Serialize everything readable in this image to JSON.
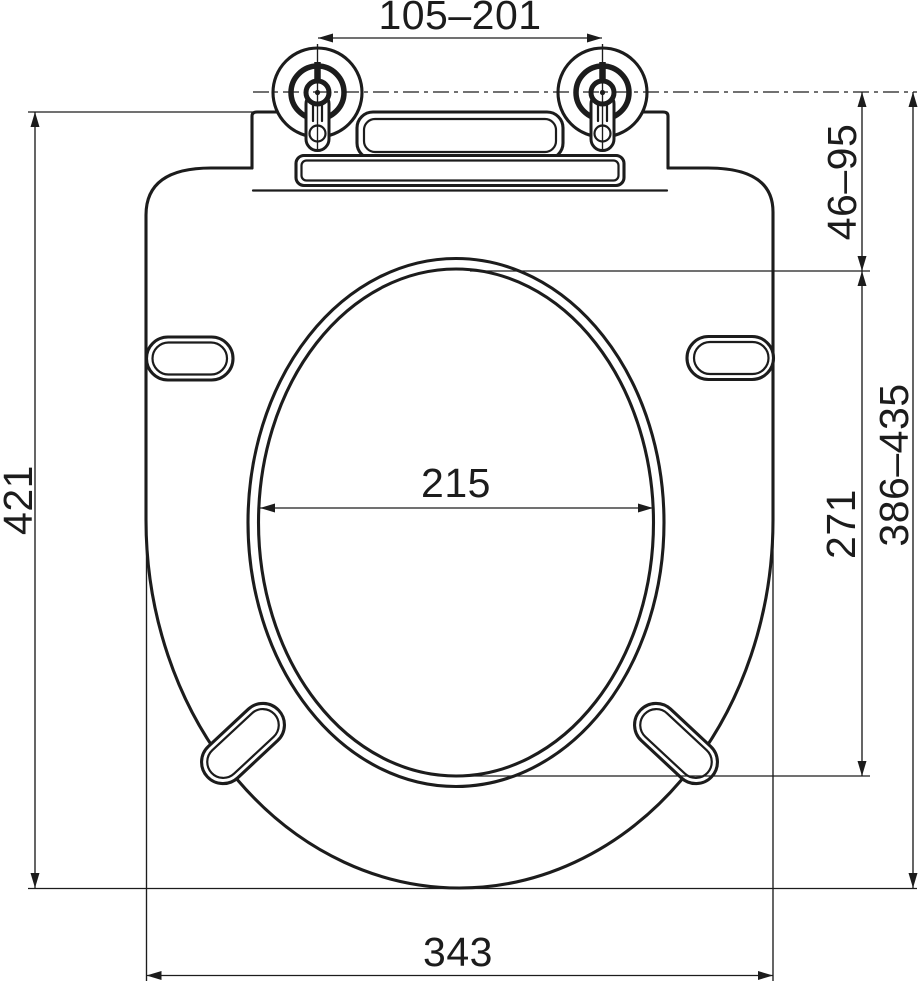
{
  "drawing": {
    "type": "technical-dimension-drawing",
    "subject": "toilet seat with lid, top view, adjustable hinges",
    "line_color": "#1c1c1c",
    "background_color": "#ffffff",
    "units_implied": "mm"
  },
  "dimensions": {
    "hinge_center_spacing": {
      "value": "105–201",
      "orientation": "horizontal",
      "position": "top"
    },
    "overall_length": {
      "value": "421",
      "orientation": "vertical",
      "position": "left"
    },
    "hinge_axis_to_opening": {
      "value": "46–95",
      "orientation": "vertical",
      "position": "right-upper"
    },
    "opening_width": {
      "value": "215",
      "orientation": "horizontal",
      "position": "center"
    },
    "opening_length": {
      "value": "271",
      "orientation": "vertical",
      "position": "right-inner"
    },
    "hinge_axis_to_front": {
      "value": "386–435",
      "orientation": "vertical",
      "position": "right-outer"
    },
    "overall_width": {
      "value": "343",
      "orientation": "horizontal",
      "position": "bottom"
    }
  }
}
